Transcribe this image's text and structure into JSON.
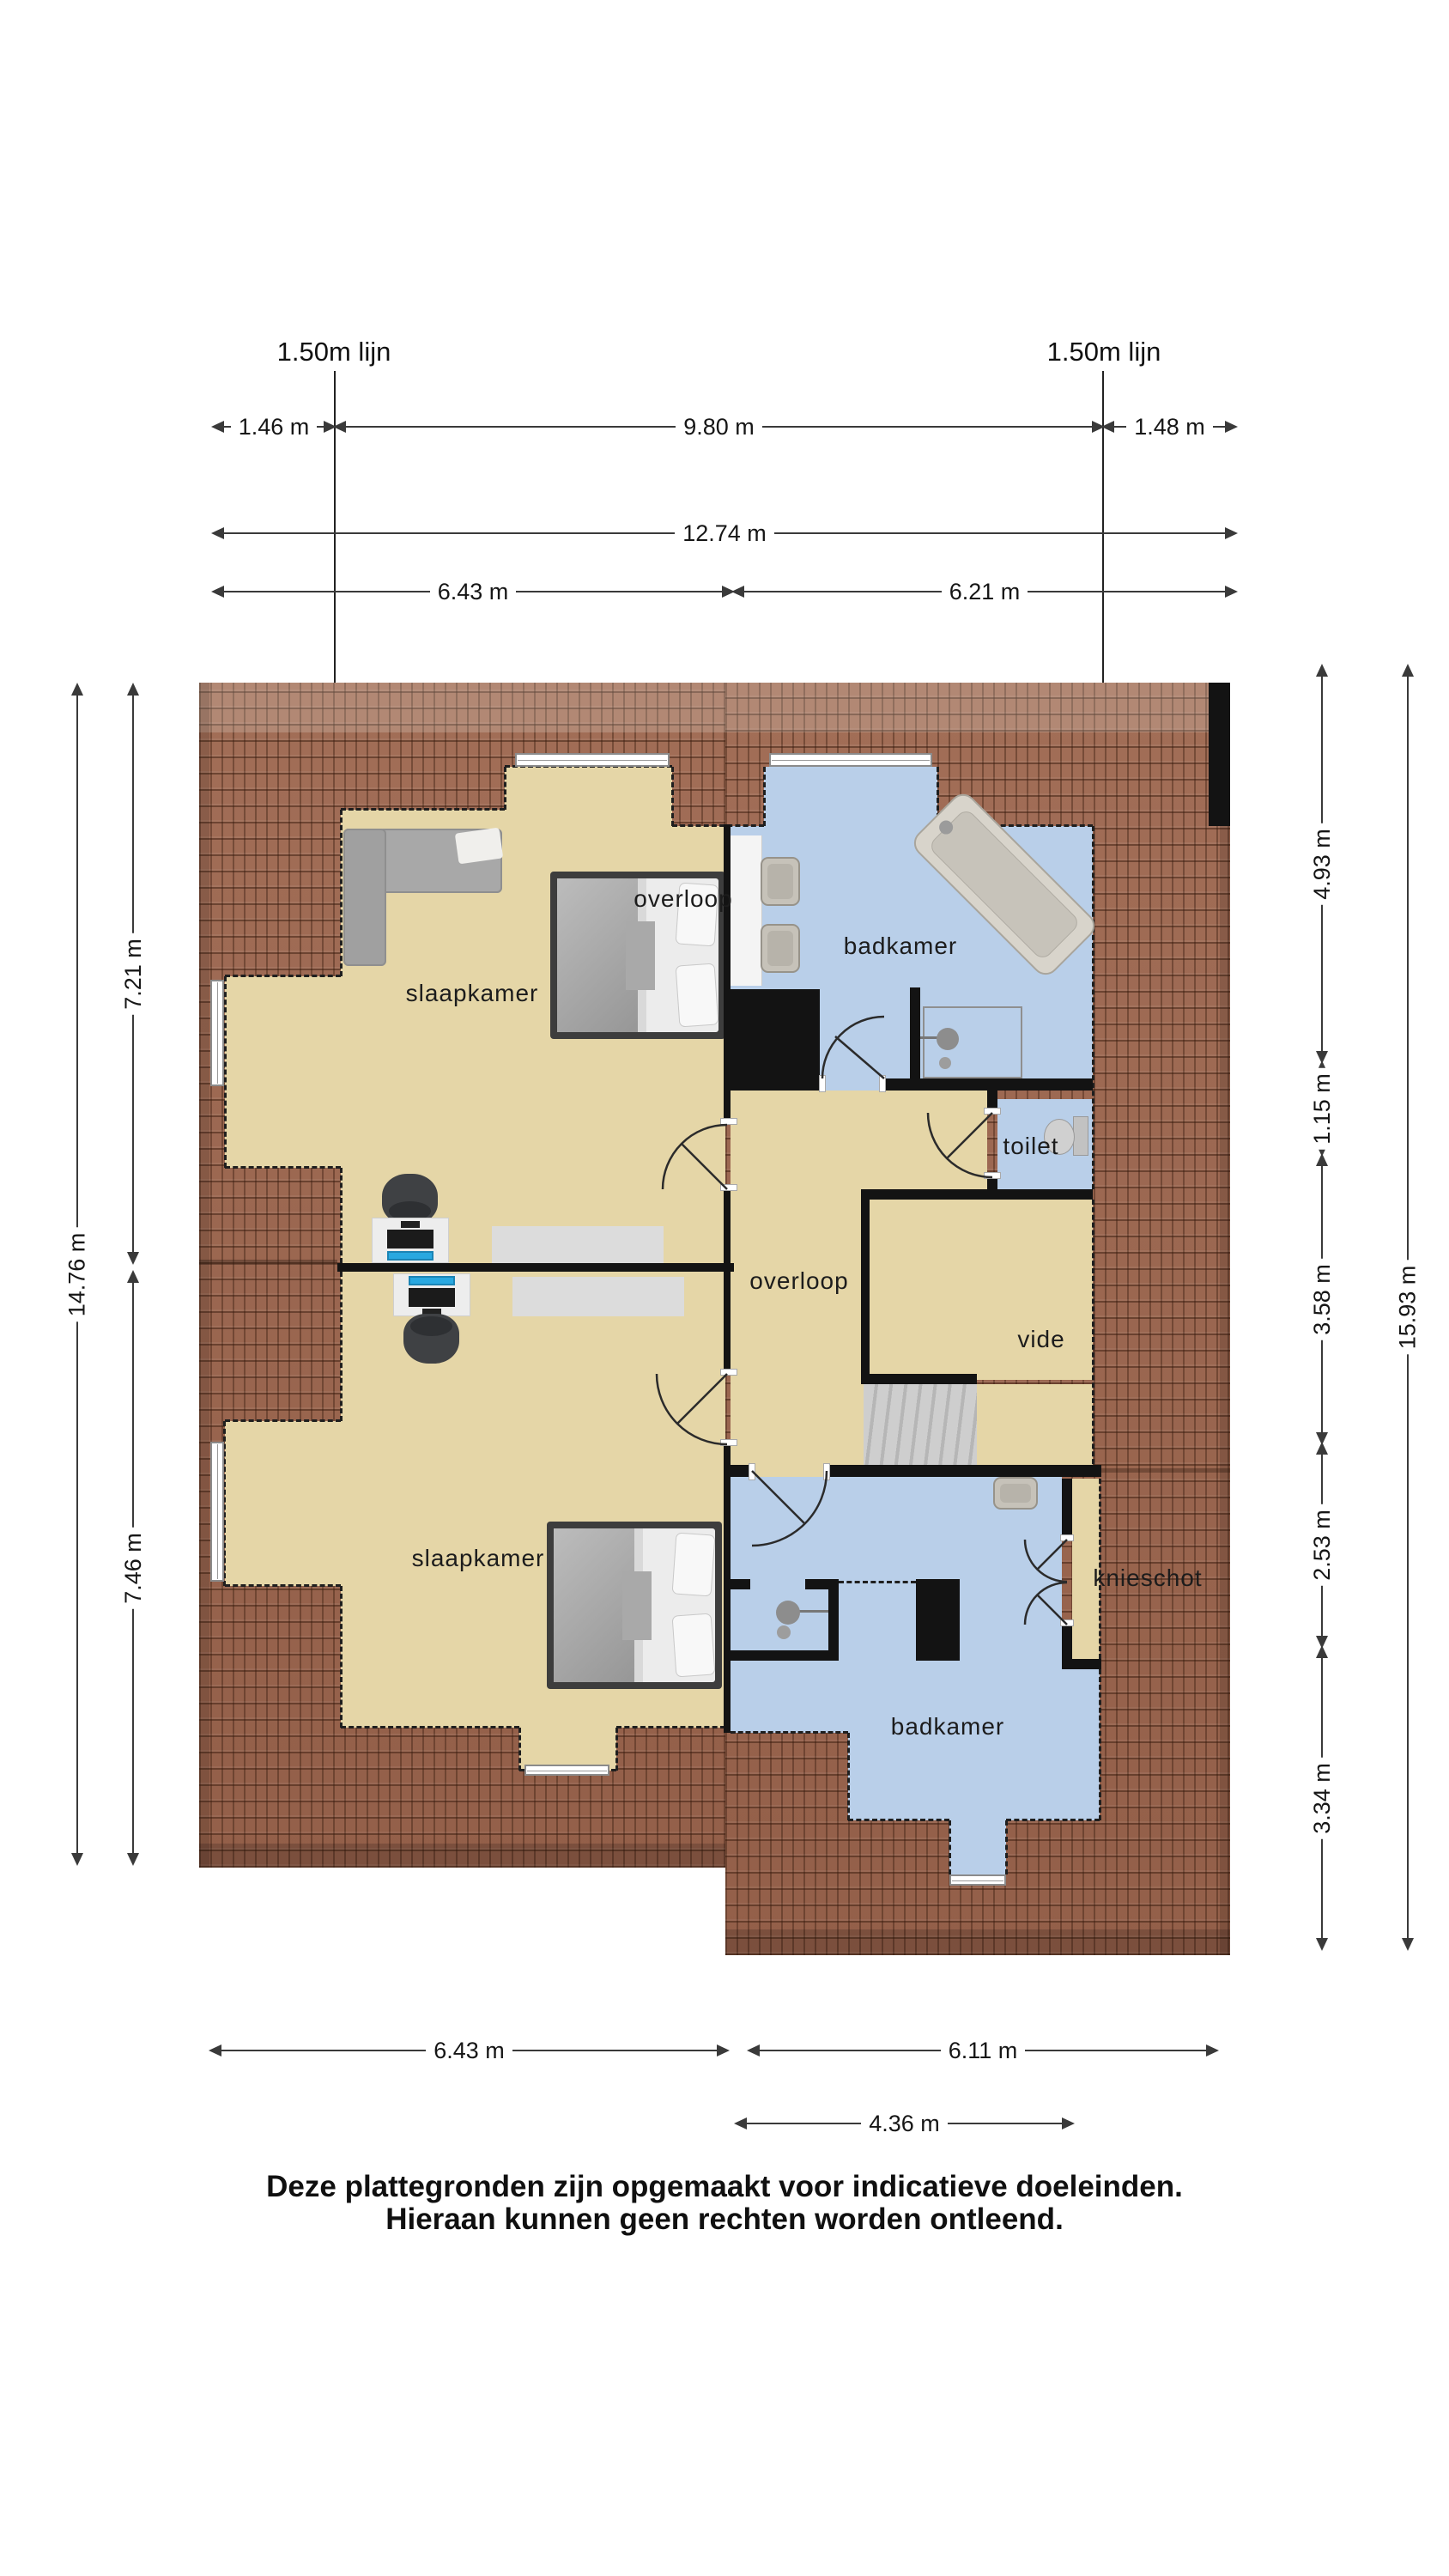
{
  "reference_lines": {
    "left": "1.50m lijn",
    "right": "1.50m lijn"
  },
  "dimensions": {
    "top_146": "1.46 m",
    "top_980": "9.80 m",
    "top_148": "1.48 m",
    "top_1274": "12.74 m",
    "top_643": "6.43 m",
    "top_621": "6.21 m",
    "left_721": "7.21 m",
    "left_1476": "14.76 m",
    "left_746": "7.46 m",
    "right_493": "4.93 m",
    "right_115": "1.15 m",
    "right_358": "3.58 m",
    "right_253": "2.53 m",
    "right_334": "3.34 m",
    "right_1593": "15.93 m",
    "bottom_643": "6.43 m",
    "bottom_611": "6.11 m",
    "bottom_436": "4.36 m"
  },
  "rooms": {
    "slaapkamer_top": "slaapkamer",
    "overloop_top": "overloop",
    "badkamer_top": "badkamer",
    "toilet": "toilet",
    "overloop_mid": "overloop",
    "vide": "vide",
    "slaapkamer_bottom": "slaapkamer",
    "knieschot": "knieschot",
    "badkamer_bottom": "badkamer"
  },
  "disclaimer": {
    "line1": "Deze plattegronden zijn opgemaakt voor indicatieve doeleinden.",
    "line2": "Hieraan kunnen geen rechten worden ontleend."
  },
  "colors": {
    "roof": "#9c6850",
    "floor_beige": "#e5d6a7",
    "floor_blue": "#b9cfe9",
    "wall": "#131313",
    "screen_accent": "#29a8e0"
  }
}
